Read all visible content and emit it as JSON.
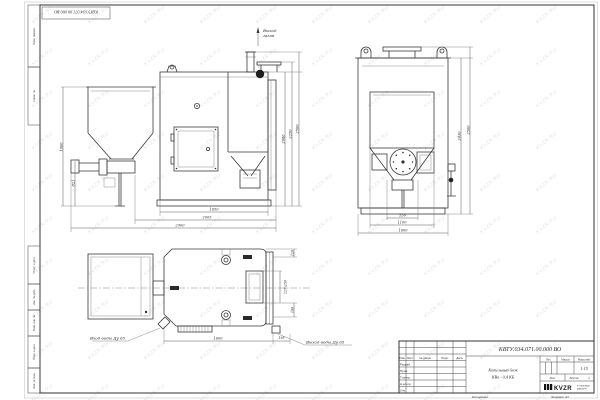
{
  "sheet": {
    "stamp_top": "КВТУ.034.071.00.000 ВО",
    "watermark": "KVZR.RU",
    "copied_label": "Копировал",
    "format_label": "Формат А3",
    "frame_labels": {
      "perv": "Перв. примен.",
      "sprav": "Справ. №",
      "podp1": "Подп. и дата",
      "inv_dubl": "Инв. № дубл.",
      "vzam": "Взам. инв. №",
      "podp2": "Подп. и дата",
      "inv_podl": "Инв. № подл."
    }
  },
  "side_view": {
    "gas_outlet_line1": "Выход",
    "gas_outlet_line2": "газов",
    "dim_height_hopper": "1900",
    "dim_height_feeder": "821",
    "dim_height_body": "2086",
    "dim_height_flange": "2250",
    "dim_height_total": "2500",
    "dim_len_inner": "1650",
    "dim_len_boiler": "2005",
    "dim_len_total": "2900"
  },
  "front_view": {
    "dim_width_outlet": "550",
    "dim_width_hopper": "1100",
    "dim_width_total": "1600",
    "dim_height_body": "2430",
    "dim_height_total": "2500"
  },
  "plan_view": {
    "water_inlet": "Вход воды Ду 65",
    "water_outlet": "Выход воды Ду 65",
    "dim_len_total": "1600",
    "dim_out_offset": "195",
    "dim_flange": "120",
    "dim_port": "225х250",
    "dim_low": "100"
  },
  "title_block": {
    "doc_number": "КВТУ.034.071.00.000 ВО",
    "name_line1": "Котельный блок",
    "name_line2": "КВа - 0,4 КБ",
    "col_izm": "Изм.",
    "col_list": "Лист",
    "col_doc": "№ докум.",
    "col_podp": "Подп.",
    "col_data": "Дата",
    "row_razrab": "Разраб.",
    "row_prov": "Пров.",
    "row_tkontr": "Т.контр.",
    "row_nkontr": "Н.контр.",
    "row_utv": "Утв.",
    "lit_label": "Лит.",
    "mass_label": "Масса",
    "scale_label": "Масштаб",
    "scale_value": "1:15",
    "sheet_label": "Лист",
    "sheets_label": "Листов",
    "sheets_value": "1",
    "logo_text": "KVZR",
    "logo_sub1": "КОТЕЛЬНЫЙ",
    "logo_sub2": "ЗАВОД.РУ"
  }
}
